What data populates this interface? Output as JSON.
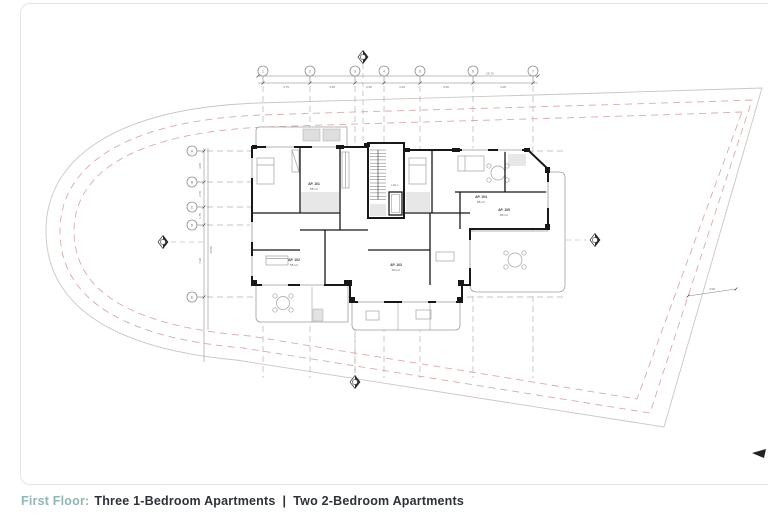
{
  "caption": {
    "prefix": "First Floor:",
    "body1": "Three 1-Bedroom Apartments",
    "separator": "|",
    "body2": "Two 2-Bedroom Apartments",
    "prefix_color": "#93b5b3",
    "text_color": "#2d3237"
  },
  "drawing": {
    "colors": {
      "wall": "#17181a",
      "thin_line": "#9e9e9e",
      "site_boundary": "#cbc6c4",
      "setback_dashed": "#d9abab",
      "grid_dashed": "#b3b3b3",
      "light_fill": "#e7e7e7",
      "frame_border": "#e4e4e4"
    },
    "grid": {
      "top_labels": [
        "1",
        "2",
        "3",
        "4",
        "5",
        "6",
        "7"
      ],
      "left_labels": [
        "A",
        "B",
        "C",
        "D",
        "E"
      ]
    },
    "dims": {
      "top_overall": "25.70",
      "top_segments": [
        "4.75",
        "4.35",
        "2.05",
        "3.40",
        "4.50",
        "4.05"
      ],
      "left_overall": "14.50",
      "left_segments": [
        "3.05",
        "2.70",
        "1.75",
        "7.20"
      ],
      "right_dim": "3.00"
    },
    "apartments": [
      {
        "label": "AP. 101",
        "area": "55 m²"
      },
      {
        "label": "AP. 102",
        "area": "55 m²"
      },
      {
        "label": "AP. 103",
        "area": "60 m²"
      },
      {
        "label": "AP. 104",
        "area": "85 m²"
      },
      {
        "label": "AP. 105",
        "area": "83 m²"
      }
    ],
    "rooms": {
      "core": "HALL"
    }
  }
}
